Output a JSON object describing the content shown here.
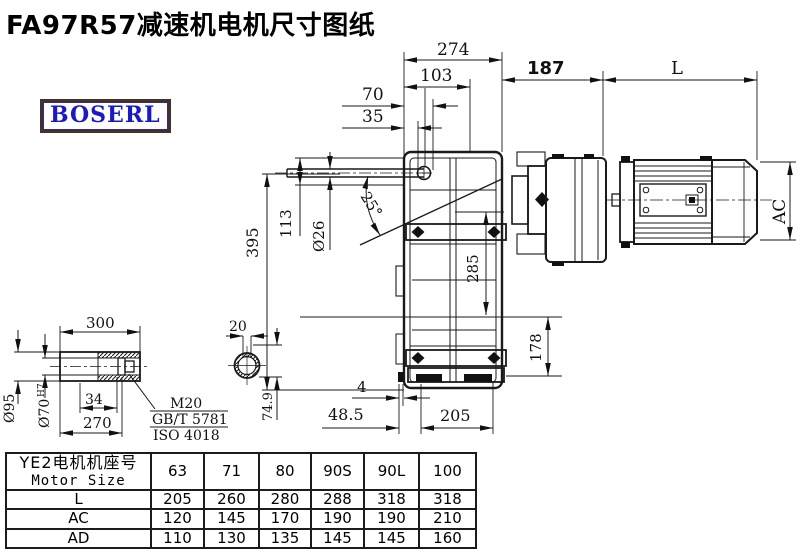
{
  "title": "FA97R57减速机电机尺寸图纸",
  "logo": "BOSERL",
  "dimensions": {
    "top": {
      "d274": "274",
      "d103": "103",
      "d70": "70",
      "d35": "35",
      "d187": "187",
      "dL": "L"
    },
    "left": {
      "d395": "395",
      "d113": "113",
      "d26": "Ø26",
      "angle": "25°"
    },
    "middle": {
      "d285": "285",
      "d178": "178",
      "dAC": "AC"
    },
    "bottom": {
      "d4": "4",
      "d48_5": "48.5",
      "d205": "205"
    },
    "shaft_detail": {
      "d300": "300",
      "d95": "Ø95",
      "d70bore": "Ø70",
      "d70tol": "H7",
      "d34": "34",
      "d270": "270",
      "note1": "M20",
      "note2": "GB/T 5781",
      "note3": "ISO 4018"
    },
    "section_detail": {
      "d20": "20",
      "d74_9": "74.9"
    }
  },
  "table": {
    "header_cn": "YE2电机机座号",
    "header_en": "Motor Size",
    "col_headers": [
      "63",
      "71",
      "80",
      "90S",
      "90L",
      "100"
    ],
    "rows": [
      {
        "label": "L",
        "values": [
          "205",
          "260",
          "280",
          "288",
          "318",
          "318"
        ]
      },
      {
        "label": "AC",
        "values": [
          "120",
          "145",
          "170",
          "190",
          "190",
          "210"
        ]
      },
      {
        "label": "AD",
        "values": [
          "110",
          "130",
          "135",
          "145",
          "145",
          "160"
        ]
      }
    ]
  },
  "colors": {
    "line": "#1a1a1a",
    "logo_text": "#1a1ac4",
    "logo_border": "#46302a",
    "background": "#ffffff"
  }
}
